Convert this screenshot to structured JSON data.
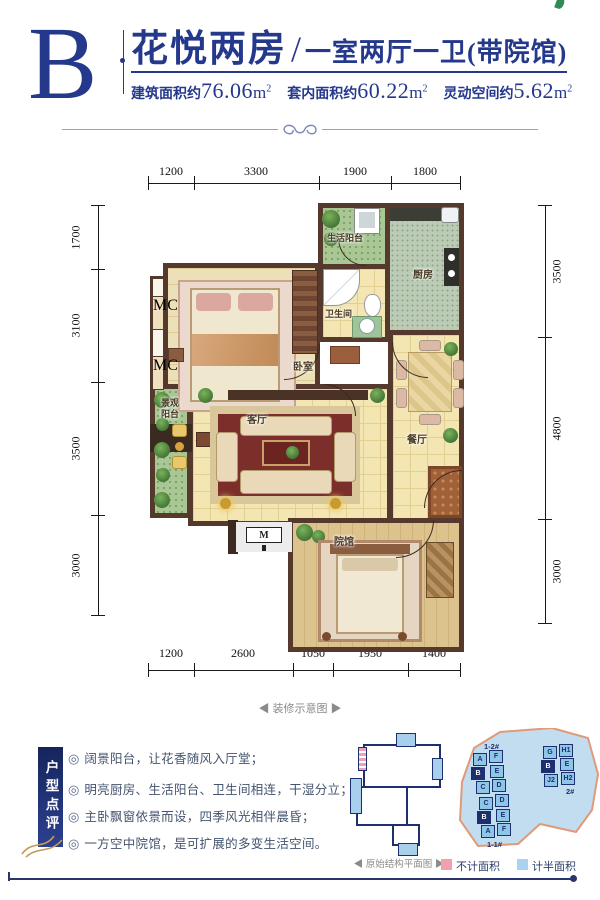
{
  "header": {
    "plan_letter": "B",
    "title": "花悦两房",
    "separator": "/",
    "subtitle": "一室两厅一卫(带院馆)",
    "stats": [
      {
        "label": "建筑面积约",
        "value": "76.06",
        "unit": "m",
        "sup": "2"
      },
      {
        "label": "套内面积约",
        "value": "60.22",
        "unit": "m",
        "sup": "2"
      },
      {
        "label": "灵动空间约",
        "value": "5.62",
        "unit": "m",
        "sup": "2"
      }
    ]
  },
  "plan": {
    "dims_top": [
      "1200",
      "3300",
      "1900",
      "1800"
    ],
    "dims_left": [
      "1700",
      "3100",
      "3500",
      "3000"
    ],
    "dims_right": [
      "3500",
      "4800",
      "3000"
    ],
    "dims_bottom": [
      "1200",
      "2600",
      "1050",
      "1950",
      "1400"
    ],
    "rooms": {
      "service_balcony": "生活阳台",
      "kitchen": "厨房",
      "bathroom": "卫生间",
      "bedroom": "卧室",
      "view_balcony_line1": "景观",
      "view_balcony_line2": "阳台",
      "living": "客厅",
      "dining": "餐厅",
      "courtyard": "院馆"
    },
    "bay_window_label": "MC",
    "entry_marker": "M",
    "caption": "◀ 装修示意图 ▶"
  },
  "review": {
    "banner": "户型点评",
    "bullet": "◎",
    "points": [
      "阔景阳台，让花香随风入厅堂；",
      "明亮厨房、生活阳台、卫生间相连，干湿分立；",
      "主卧飘窗依景而设，四季风光相伴晨昏；",
      "一方空中院馆，是可扩展的多变生活空间。"
    ]
  },
  "diagrams": {
    "structure_caption": "◀ 原始结构平面图 ▶",
    "siteplan": {
      "buildings": [
        {
          "name": "1-2#",
          "units": [
            "A",
            "F",
            "B",
            "E",
            "C",
            "D"
          ]
        },
        {
          "name": "1-1#",
          "units": [
            "C",
            "D",
            "B",
            "E",
            "A",
            "F"
          ]
        },
        {
          "name": "2#",
          "units": [
            "G",
            "H1",
            "B",
            "E",
            "J2",
            "H2"
          ]
        }
      ],
      "legend": [
        {
          "label": "不计面积",
          "color": "#f2a0b0"
        },
        {
          "label": "计半面积",
          "color": "#a8d4ee"
        }
      ]
    }
  },
  "colors": {
    "brand_navy": "#24388c",
    "wall_brown": "#55392c",
    "floor_cream": "#f4e6b2",
    "kitchen_green": "#bccbb6",
    "balcony_green": "#a9c795",
    "site_land_blue": "#c2ddf0",
    "site_outline_salmon": "#e09a78",
    "legend_pink": "#f2a0b0",
    "legend_blue": "#a8d4ee"
  }
}
